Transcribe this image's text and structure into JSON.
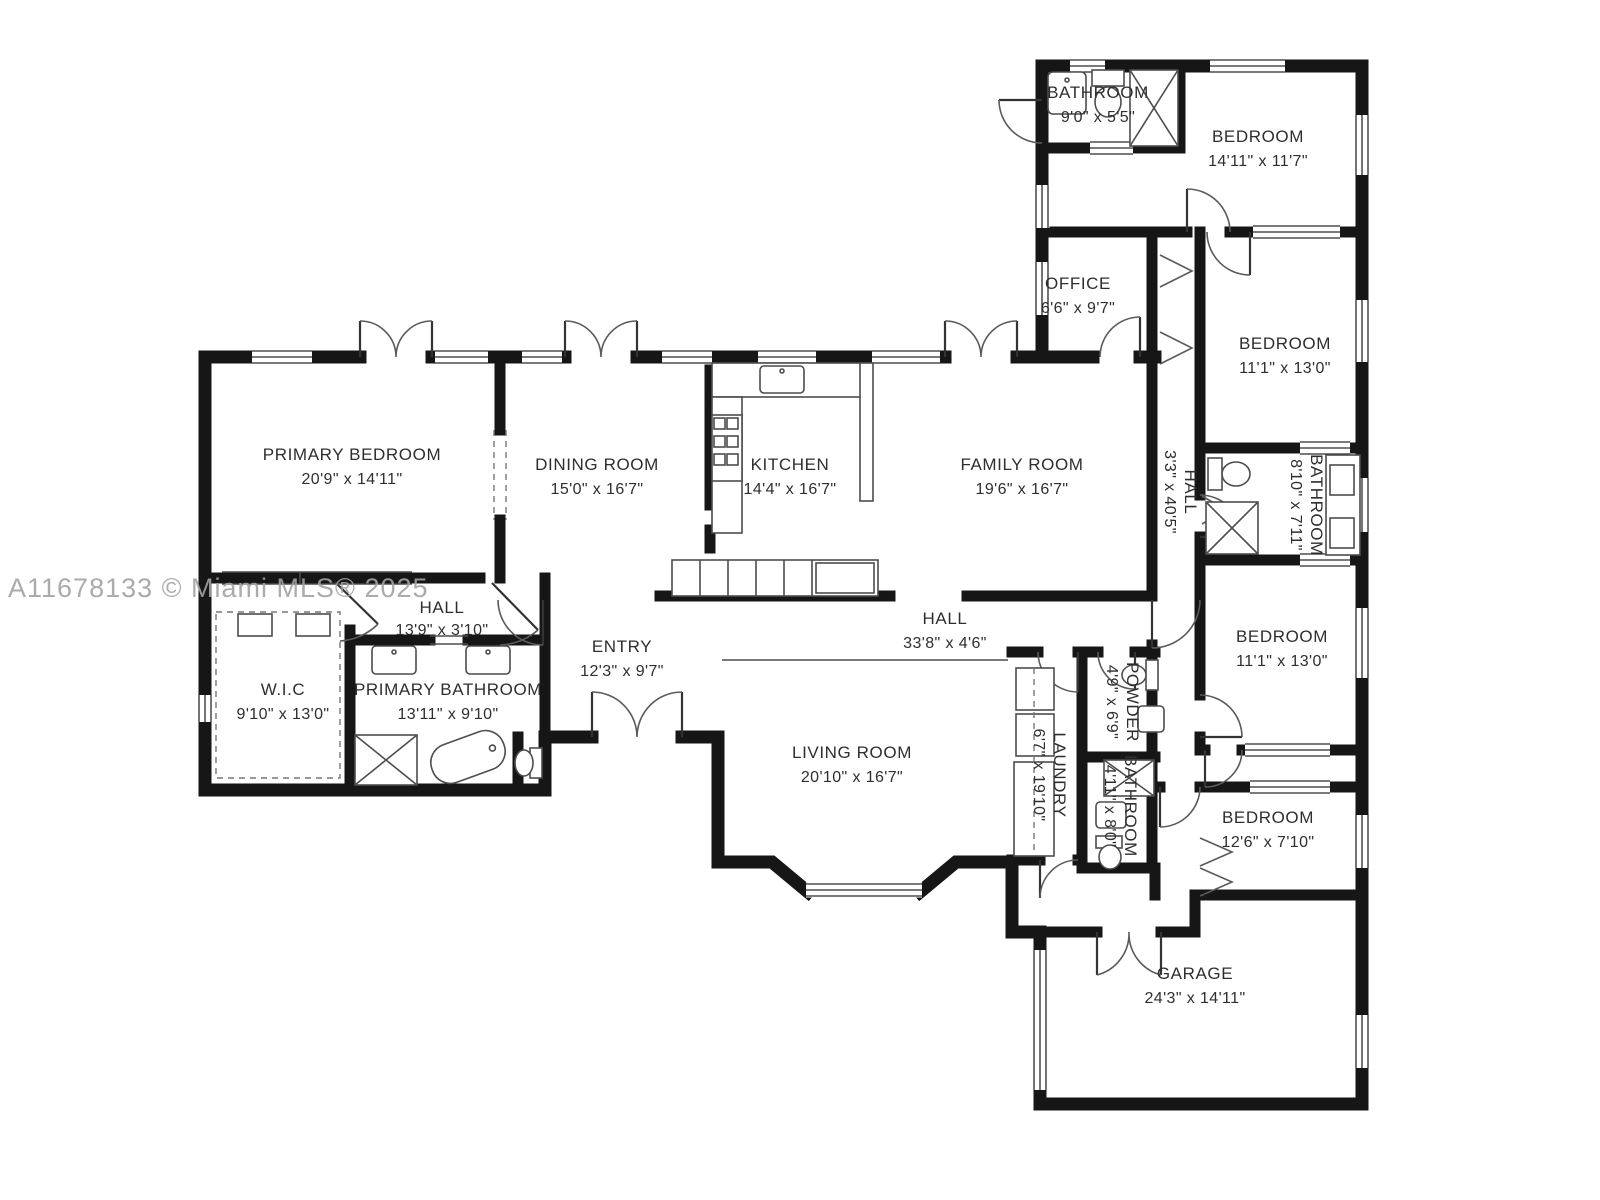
{
  "watermark": "A11678133 © Miami MLS® 2025",
  "colors": {
    "wall": "#161616",
    "fixture": "#4d4d4d",
    "text": "#2e2e2e",
    "watermark": "#a2a2a2",
    "background": "#ffffff"
  },
  "rooms": {
    "bathroom_top": {
      "name": "BATHROOM",
      "dims": "9'0\" x 5'5\""
    },
    "bedroom_ne": {
      "name": "BEDROOM",
      "dims": "14'11\" x 11'7\""
    },
    "office": {
      "name": "OFFICE",
      "dims": "6'6\" x 9'7\""
    },
    "bedroom_e1": {
      "name": "BEDROOM",
      "dims": "11'1\" x 13'0\""
    },
    "hall_e": {
      "name": "HALL",
      "dims": "3'3\" x 40'5\""
    },
    "bathroom_e": {
      "name": "BATHROOM",
      "dims": "8'10\" x 7'11\""
    },
    "primary_bedroom": {
      "name": "PRIMARY BEDROOM",
      "dims": "20'9\" x 14'11\""
    },
    "dining_room": {
      "name": "DINING ROOM",
      "dims": "15'0\" x 16'7\""
    },
    "kitchen": {
      "name": "KITCHEN",
      "dims": "14'4\" x 16'7\""
    },
    "family_room": {
      "name": "FAMILY ROOM",
      "dims": "19'6\" x 16'7\""
    },
    "hall_w": {
      "name": "HALL",
      "dims": "13'9\" x 3'10\""
    },
    "wic": {
      "name": "W.I.C",
      "dims": "9'10\" x 13'0\""
    },
    "primary_bathroom": {
      "name": "PRIMARY BATHROOM",
      "dims": "13'11\" x 9'10\""
    },
    "entry": {
      "name": "ENTRY",
      "dims": "12'3\" x 9'7\""
    },
    "hall_main": {
      "name": "HALL",
      "dims": "33'8\" x 4'6\""
    },
    "living_room": {
      "name": "LIVING ROOM",
      "dims": "20'10\" x 16'7\""
    },
    "laundry": {
      "name": "LAUNDRY",
      "dims": "6'7\" x 19'10\""
    },
    "powder": {
      "name": "POWDER",
      "dims": "4'9\" x 6'9\""
    },
    "bathroom_s": {
      "name": "BATHROOM",
      "dims": "4'11\" x 8'0\""
    },
    "bedroom_e2": {
      "name": "BEDROOM",
      "dims": "11'1\" x 13'0\""
    },
    "bedroom_se": {
      "name": "BEDROOM",
      "dims": "12'6\" x 7'10\""
    },
    "garage": {
      "name": "GARAGE",
      "dims": "24'3\" x 14'11\""
    }
  }
}
